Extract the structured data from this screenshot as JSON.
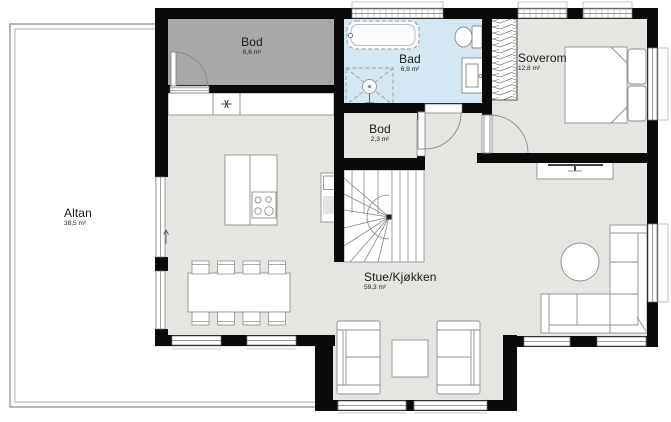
{
  "floorplan": {
    "type": "residential-floor-plan",
    "rooms": [
      {
        "id": "altan",
        "name": "Altan",
        "area": "38,5 m²"
      },
      {
        "id": "bod-storage",
        "name": "Bod",
        "area": "6,6 m²"
      },
      {
        "id": "bad-bathroom",
        "name": "Bad",
        "area": "6,9 m²"
      },
      {
        "id": "soverom",
        "name": "Soverom",
        "area": "12,8 m²"
      },
      {
        "id": "bod-small",
        "name": "Bod",
        "area": "2,3 m²"
      },
      {
        "id": "stue-kjokken",
        "name": "Stue/Kjøkken",
        "area": "59,3 m²"
      }
    ],
    "colors": {
      "wall": "#0a0a0a",
      "floor": "#e6e5e2",
      "storage_room_fill": "#a8a8a8",
      "bathroom_fill": "#d5e7f2",
      "terrace_fill": "#ffffff",
      "furniture_outline": "#8f8f8f",
      "window_frame": "#777777"
    },
    "fixtures": [
      "bathtub",
      "shower",
      "toilet",
      "vanity-sink",
      "wardrobe",
      "double-bed",
      "tv-bench",
      "corner-sofa",
      "round-table",
      "coffee-table",
      "armchair-left",
      "armchair-right",
      "dining-table",
      "dining-chairs",
      "kitchen-island",
      "cooktop",
      "kitchen-counter",
      "kitchen-sink",
      "appliance",
      "winder-stairs"
    ]
  }
}
